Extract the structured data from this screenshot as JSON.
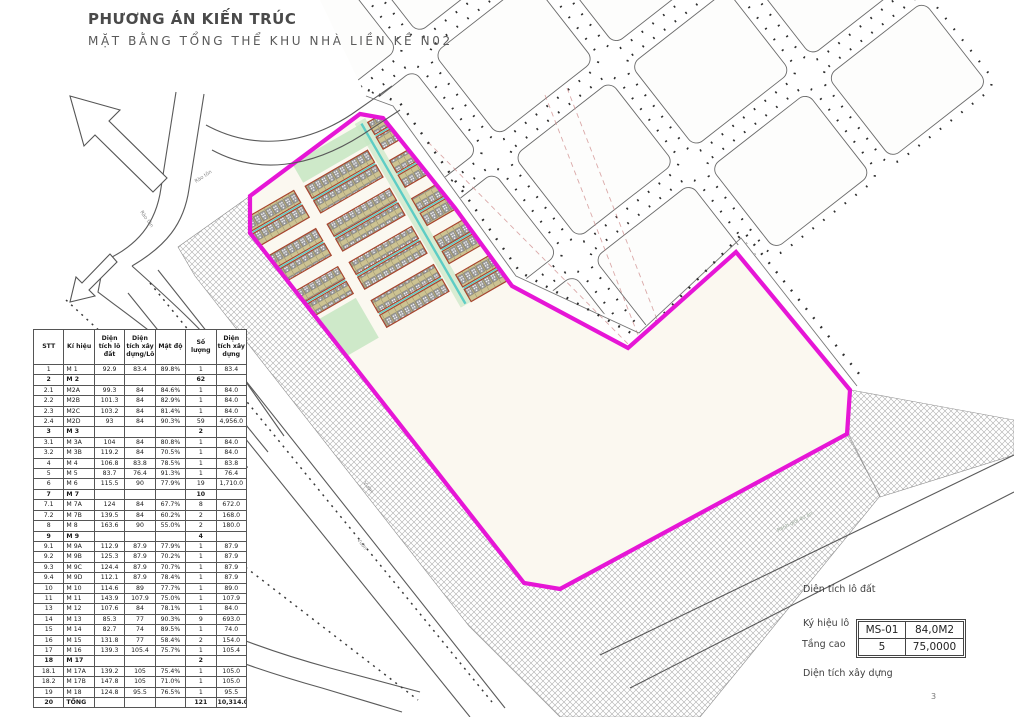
{
  "header": {
    "title": "PHƯƠNG ÁN KIẾN TRÚC",
    "subtitle": "MẶT BẰNG TỔNG THỂ KHU NHÀ LIỀN KỀ N02"
  },
  "table": {
    "headers": [
      "STT",
      "Kí hiệu",
      "Diện tích lô đất",
      "Diện tích xây dựng/Lô",
      "Mật độ",
      "Số lượng",
      "Diện tích xây dựng"
    ],
    "rows": [
      {
        "cells": [
          "1",
          "M 1",
          "92.9",
          "83.4",
          "89.8%",
          "1",
          "83.4"
        ],
        "bold": false
      },
      {
        "cells": [
          "2",
          "M 2",
          "",
          "",
          "",
          "62",
          ""
        ],
        "bold": true
      },
      {
        "cells": [
          "2.1",
          "M2A",
          "99.3",
          "84",
          "84.6%",
          "1",
          "84.0"
        ],
        "bold": false
      },
      {
        "cells": [
          "2.2",
          "M2B",
          "101.3",
          "84",
          "82.9%",
          "1",
          "84.0"
        ],
        "bold": false
      },
      {
        "cells": [
          "2.3",
          "M2C",
          "103.2",
          "84",
          "81.4%",
          "1",
          "84.0"
        ],
        "bold": false
      },
      {
        "cells": [
          "2.4",
          "M2D",
          "93",
          "84",
          "90.3%",
          "59",
          "4,956.0"
        ],
        "bold": false
      },
      {
        "cells": [
          "3",
          "M 3",
          "",
          "",
          "",
          "2",
          ""
        ],
        "bold": true
      },
      {
        "cells": [
          "3.1",
          "M 3A",
          "104",
          "84",
          "80.8%",
          "1",
          "84.0"
        ],
        "bold": false
      },
      {
        "cells": [
          "3.2",
          "M 3B",
          "119.2",
          "84",
          "70.5%",
          "1",
          "84.0"
        ],
        "bold": false
      },
      {
        "cells": [
          "4",
          "M 4",
          "106.8",
          "83.8",
          "78.5%",
          "1",
          "83.8"
        ],
        "bold": false
      },
      {
        "cells": [
          "5",
          "M 5",
          "83.7",
          "76.4",
          "91.3%",
          "1",
          "76.4"
        ],
        "bold": false
      },
      {
        "cells": [
          "6",
          "M 6",
          "115.5",
          "90",
          "77.9%",
          "19",
          "1,710.0"
        ],
        "bold": false
      },
      {
        "cells": [
          "7",
          "M 7",
          "",
          "",
          "",
          "10",
          ""
        ],
        "bold": true
      },
      {
        "cells": [
          "7.1",
          "M 7A",
          "124",
          "84",
          "67.7%",
          "8",
          "672.0"
        ],
        "bold": false
      },
      {
        "cells": [
          "7.2",
          "M 7B",
          "139.5",
          "84",
          "60.2%",
          "2",
          "168.0"
        ],
        "bold": false
      },
      {
        "cells": [
          "8",
          "M 8",
          "163.6",
          "90",
          "55.0%",
          "2",
          "180.0"
        ],
        "bold": false
      },
      {
        "cells": [
          "9",
          "M 9",
          "",
          "",
          "",
          "4",
          ""
        ],
        "bold": true
      },
      {
        "cells": [
          "9.1",
          "M 9A",
          "112.9",
          "87.9",
          "77.9%",
          "1",
          "87.9"
        ],
        "bold": false
      },
      {
        "cells": [
          "9.2",
          "M 9B",
          "125.3",
          "87.9",
          "70.2%",
          "1",
          "87.9"
        ],
        "bold": false
      },
      {
        "cells": [
          "9.3",
          "M 9C",
          "124.4",
          "87.9",
          "70.7%",
          "1",
          "87.9"
        ],
        "bold": false
      },
      {
        "cells": [
          "9.4",
          "M 9D",
          "112.1",
          "87.9",
          "78.4%",
          "1",
          "87.9"
        ],
        "bold": false
      },
      {
        "cells": [
          "10",
          "M 10",
          "114.6",
          "89",
          "77.7%",
          "1",
          "89.0"
        ],
        "bold": false
      },
      {
        "cells": [
          "11",
          "M 11",
          "143.9",
          "107.9",
          "75.0%",
          "1",
          "107.9"
        ],
        "bold": false
      },
      {
        "cells": [
          "13",
          "M 12",
          "107.6",
          "84",
          "78.1%",
          "1",
          "84.0"
        ],
        "bold": false
      },
      {
        "cells": [
          "14",
          "M 13",
          "85.3",
          "77",
          "90.3%",
          "9",
          "693.0"
        ],
        "bold": false
      },
      {
        "cells": [
          "15",
          "M 14",
          "82.7",
          "74",
          "89.5%",
          "1",
          "74.0"
        ],
        "bold": false
      },
      {
        "cells": [
          "16",
          "M 15",
          "131.8",
          "77",
          "58.4%",
          "2",
          "154.0"
        ],
        "bold": false
      },
      {
        "cells": [
          "17",
          "M 16",
          "139.3",
          "105.4",
          "75.7%",
          "1",
          "105.4"
        ],
        "bold": false
      },
      {
        "cells": [
          "18",
          "M 17",
          "",
          "",
          "",
          "2",
          ""
        ],
        "bold": true
      },
      {
        "cells": [
          "18.1",
          "M 17A",
          "139.2",
          "105",
          "75.4%",
          "1",
          "105.0"
        ],
        "bold": false
      },
      {
        "cells": [
          "18.2",
          "M 17B",
          "147.8",
          "105",
          "71.0%",
          "1",
          "105.0"
        ],
        "bold": false
      },
      {
        "cells": [
          "19",
          "M 18",
          "124.8",
          "95.5",
          "76.5%",
          "1",
          "95.5"
        ],
        "bold": false
      },
      {
        "cells": [
          "20",
          "TỔNG",
          "",
          "",
          "",
          "121",
          "10,314.0"
        ],
        "bold": true
      }
    ]
  },
  "plan": {
    "labels": {
      "fence": "Rào tôn",
      "garden": "Vườn",
      "boundary_note": "Ranh giới dự án"
    },
    "colors": {
      "boundary": "#e616d6",
      "row_outline": "#a8442c",
      "row_fill": "#cdc392",
      "unit_fill": "#9c9c9e",
      "water": "#5ecdc5",
      "green": "#c9e7c4",
      "hatch": "#ababab",
      "road_line": "#5a5a5a",
      "dashed_red": "#cf8d8d",
      "block_stroke": "#6a6a6a",
      "tree": "#2e2e2e"
    }
  },
  "legend": {
    "lot_area_label": "Diện tích lô đất",
    "lot_code_label": "Ký hiệu lô",
    "floors_label": "Tầng cao",
    "build_area_label": "Diện tích xây dựng",
    "box": {
      "code": "MS-01",
      "lot_area": "84,0M2",
      "floors": "5",
      "build_area": "75,0000"
    }
  },
  "page_number": "3"
}
